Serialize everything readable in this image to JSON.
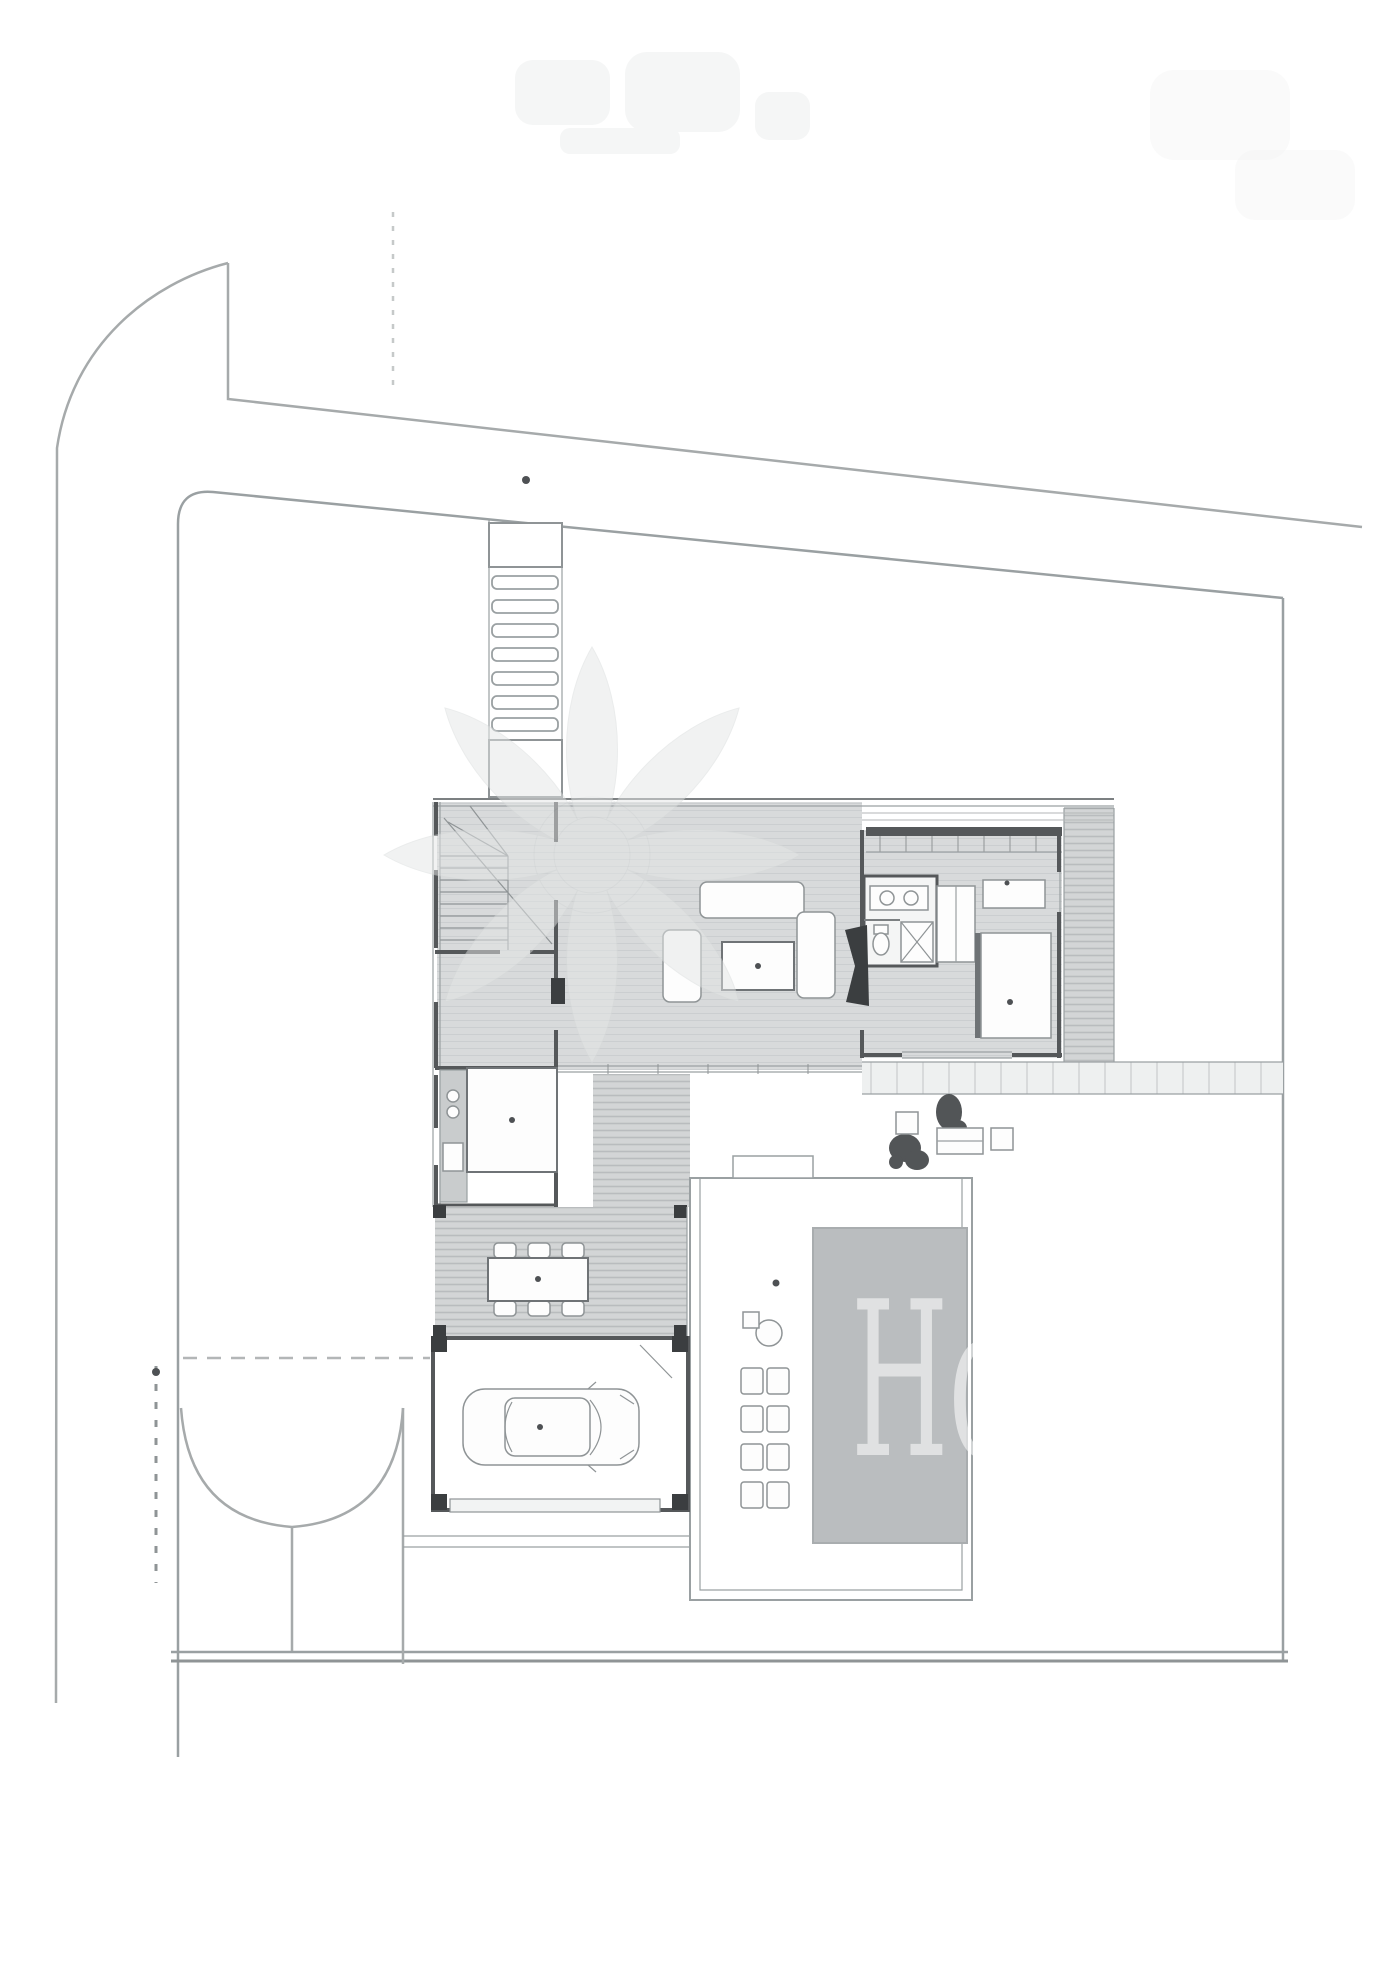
{
  "watermark": {
    "letters": "Ho",
    "symbol": "lotus-flower-watermark",
    "letters_fill": "rgba(255,255,255,0.55)"
  },
  "colors": {
    "background": "#ffffff",
    "site_line": "#a6aaab",
    "parcel_line": "#9aa0a2",
    "wall": "#55585a",
    "wall_dark": "#3b3e40",
    "floor_gray": "#d8dadb",
    "floor_hatch": "#cbced0",
    "deck_slat": "#b9bcbe",
    "boardwalk": "#eef0f0",
    "pool": "#babdbf",
    "pool_edge": "#a9adaf",
    "furniture_stroke": "#8f9496",
    "accent_dot": "#4e5154",
    "watermark_tint": "#e4e6e6"
  },
  "plan_features": [
    "street-curb",
    "plot-boundary",
    "entry-walkway",
    "stepping-stones",
    "entry-landing",
    "staircase",
    "entry-hall",
    "wc",
    "kitchen",
    "kitchen-island",
    "living-room",
    "sofa",
    "coffee-table",
    "fireplace",
    "bathroom",
    "wardrobe",
    "bedroom",
    "bed",
    "dresser",
    "east-deck",
    "north-trellis",
    "boardwalk",
    "side-deck",
    "pergola-dining-terrace",
    "dining-table",
    "dining-chairs",
    "garage",
    "car",
    "garage-door",
    "driveway",
    "gate-dashed-line",
    "pool-terrace",
    "pool",
    "lounge-table",
    "sun-loungers",
    "planters",
    "annotation-marks"
  ]
}
